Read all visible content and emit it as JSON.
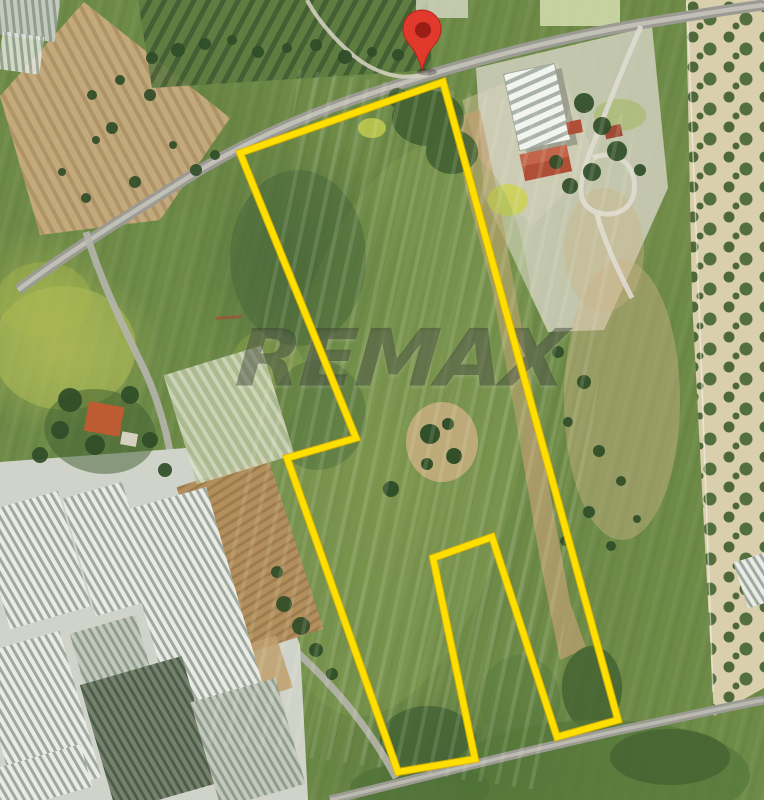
{
  "watermark": {
    "text": "REMAX"
  },
  "map_pin": {
    "type": "location-marker",
    "body_color": "#e2392d",
    "dot_color": "#9b1d15"
  },
  "parcel": {
    "boundary_color": "#ffdf00",
    "boundary_points": "443,82 240,153 356,438 287,458 398,772 475,759 433,558 492,537 557,737 618,720"
  },
  "palette": {
    "grass_green": "#6d8a47",
    "dark_trees_green": "#2f4d28",
    "plowed_field_tan": "#c4a87c",
    "road_gray": "#9b9b93",
    "greenhouse_white": "#e9ece6",
    "olive_band_tan": "#d9cfad",
    "pin_red": "#e2392d",
    "boundary_yellow": "#ffdf00"
  }
}
